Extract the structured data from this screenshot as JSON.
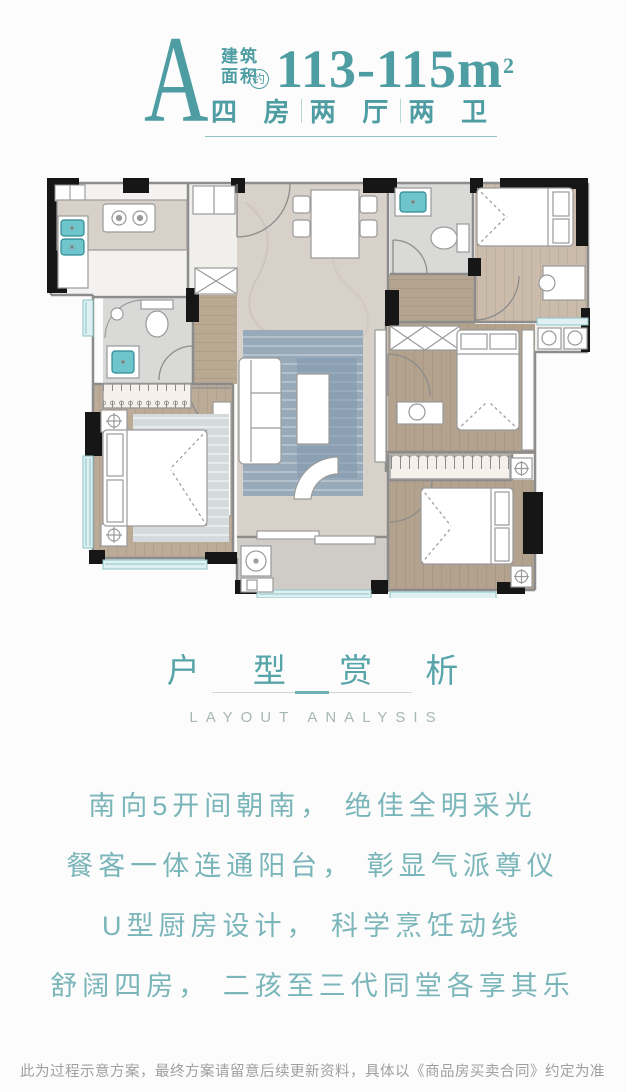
{
  "header": {
    "plan_letter": "A",
    "area_label_top": "建筑",
    "area_label_bottom": "面积",
    "approx_badge": "约",
    "area_value": "113-115m",
    "area_exponent": "2",
    "specs": [
      {
        "label": "四 房"
      },
      {
        "label": "两 厅"
      },
      {
        "label": "两 卫"
      }
    ],
    "accent_color": "#4e9da3"
  },
  "floorplan": {
    "type": "residential-floor-plan",
    "rooms": [
      "kitchen",
      "foyer",
      "dining-room",
      "guest-bathroom",
      "bedroom-top-right",
      "corridor",
      "bedroom-right",
      "bedroom-bottom-right",
      "master-bathroom",
      "master-bedroom",
      "living-room",
      "service-balcony",
      "ac-platform"
    ],
    "furniture": [
      "kitchen-sink",
      "stove",
      "dining-table",
      "dining-chairs",
      "toilet",
      "wash-basin",
      "double-bed",
      "single-bed",
      "desk",
      "chair",
      "wardrobe",
      "sofa",
      "coffee-table",
      "lounge-chair",
      "tv-console",
      "washing-machine",
      "nightstand",
      "rug",
      "shower"
    ],
    "palette": {
      "wall_black": "#161616",
      "wall_gray": "#8c8c8c",
      "wood_floor": "#bcab97",
      "wood_floor_dark": "#ab9a86",
      "marble_floor": "#d8d1ca",
      "tile_floor": "#d9d9d7",
      "balcony_floor": "#cfccc8",
      "rug_blue": "#98aaba",
      "rug_gray": "#d5dadd",
      "fixture_teal": "#6fc5cc",
      "window_band": "#def0f1",
      "furniture_fill": "#ffffff"
    }
  },
  "analysis": {
    "title": "户 型 赏 析",
    "subtitle": "LAYOUT ANALYSIS",
    "lines": [
      "南向5开间朝南， 绝佳全明采光",
      "餐客一体连通阳台， 彰显气派尊仪",
      "U型厨房设计， 科学烹饪动线",
      "舒阔四房， 二孩至三代同堂各享其乐"
    ]
  },
  "footer": {
    "disclaimer": "此为过程示意方案，最终方案请留意后续更新资料，具体以《商品房买卖合同》约定为准"
  }
}
